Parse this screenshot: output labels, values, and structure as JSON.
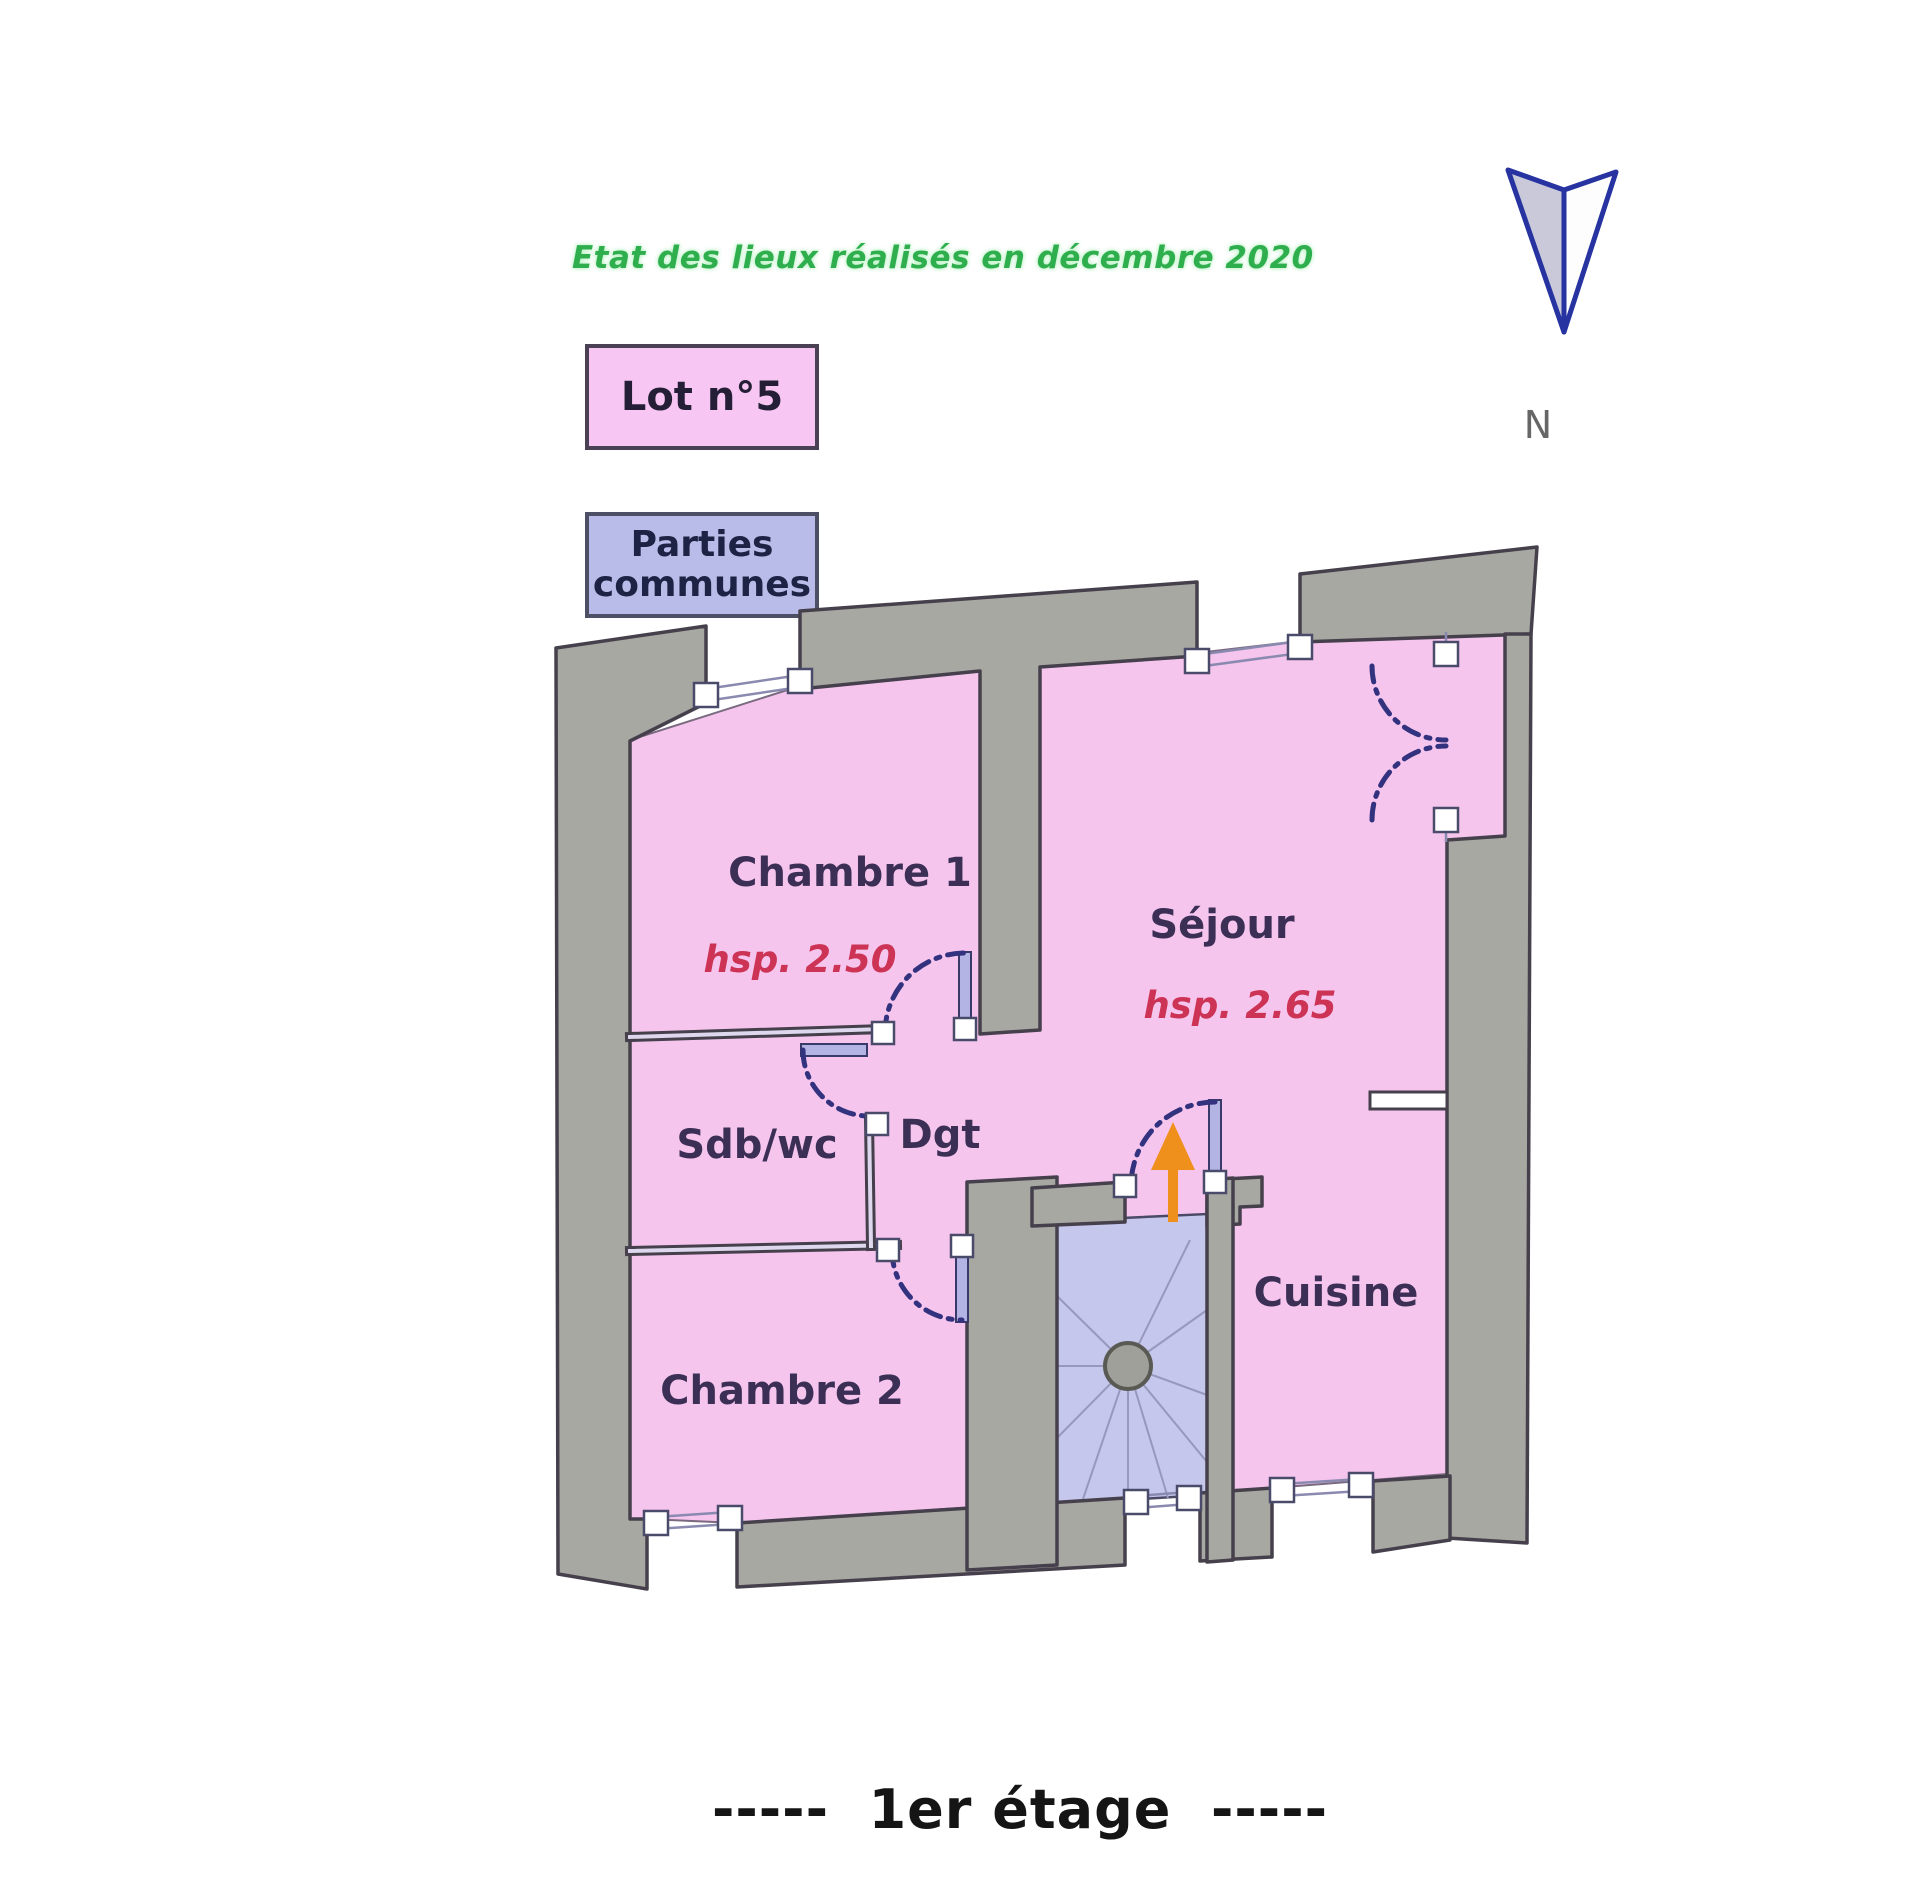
{
  "header": {
    "title": "Etat des lieux réalisés en décembre 2020"
  },
  "legend": {
    "lot": {
      "label": "Lot n°5",
      "fill": "#f8c6f2"
    },
    "communes": {
      "label_line1": "Parties",
      "label_line2": "communes",
      "fill": "#b9bce8"
    }
  },
  "compass": {
    "label": "N"
  },
  "plan": {
    "rooms": [
      {
        "name": "Chambre 1",
        "hsp": "hsp. 2.50"
      },
      {
        "name": "Séjour",
        "hsp": "hsp. 2.65"
      },
      {
        "name": "Sdb/wc"
      },
      {
        "name": "Dgt"
      },
      {
        "name": "Chambre 2"
      },
      {
        "name": "Cuisine"
      }
    ]
  },
  "colors": {
    "private_lot_pink": "#f5c5ee",
    "common_area_blue": "#c5c7ec",
    "wall_gray": "#a8a8a2",
    "wall_outline": "#46404c",
    "door_arc_navy": "#32327e",
    "hsp_text_red": "#cc3355",
    "label_navy": "#3c2f55",
    "title_green": "#2fae4e",
    "arrow_orange": "#ef8f1c"
  },
  "footer": {
    "caption": "-----  1er étage  -----"
  }
}
